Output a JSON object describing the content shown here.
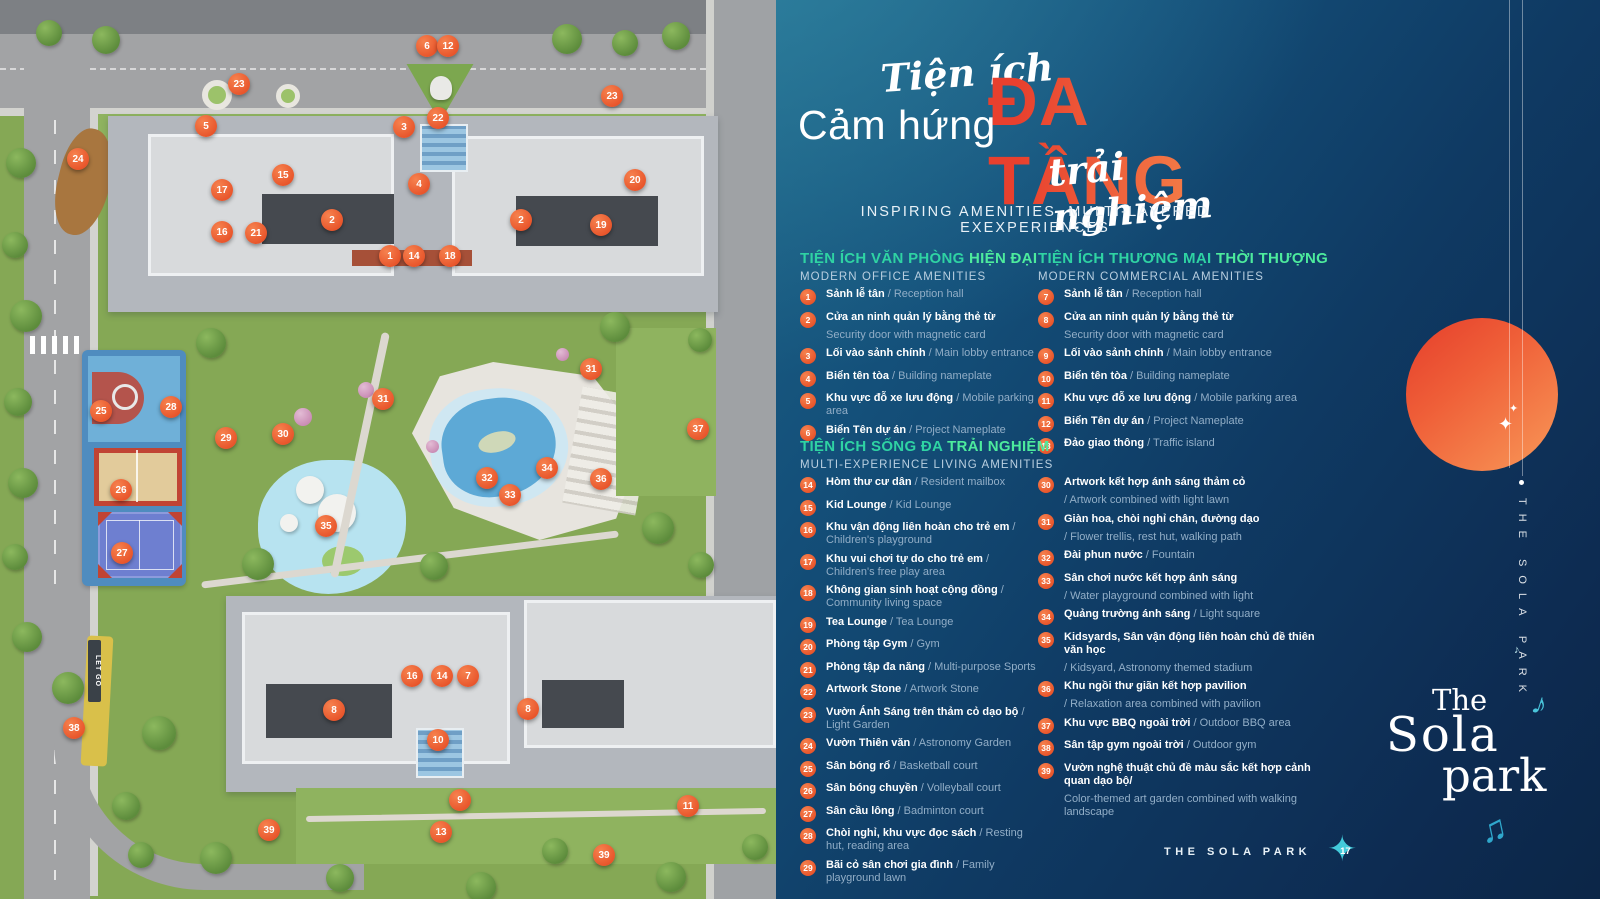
{
  "title": {
    "script_top": "Tiện ích",
    "main_left": "Cảm hứng",
    "main_accent": "ĐA TẦNG",
    "script_bottom": "trải nghiệm",
    "subtitle": "INSPIRING AMENITIES, MULTI-LAYERED EXEXPERIENCES"
  },
  "colors": {
    "accent_orange": "#F26A39",
    "title_gradient_start": "#E8402E",
    "title_gradient_end": "#F78F4F",
    "header_teal": "#2FD3A3",
    "header_teal_accent": "#4DEB9D",
    "panel_navy": "#0D2B51",
    "panel_teal": "#1C6386",
    "marker_orange": "#E8542A",
    "note_teal": "#49C4DA",
    "sun_red": "#E6422D",
    "sun_orange": "#F68A50"
  },
  "legend": {
    "sections": [
      {
        "title_vi": "TIỆN ÍCH VĂN PHÒNG ",
        "title_accent": "HIỆN ĐẠI",
        "title_en": "MODERN OFFICE AMENITIES",
        "items": [
          {
            "n": 1,
            "vi": "Sảnh lễ tân",
            "en": "/ Reception hall",
            "stack": false
          },
          {
            "n": 2,
            "vi": "Cửa an ninh quản lý bằng thẻ từ",
            "en": "Security door with magnetic card",
            "stack": true
          },
          {
            "n": 3,
            "vi": "Lối vào sảnh chính",
            "en": "/ Main lobby entrance",
            "stack": false
          },
          {
            "n": 4,
            "vi": "Biển tên tòa",
            "en": "/ Building nameplate",
            "stack": false
          },
          {
            "n": 5,
            "vi": "Khu vực đỗ xe lưu động",
            "en": "/ Mobile parking area",
            "stack": false
          },
          {
            "n": 6,
            "vi": "Biển Tên dự án",
            "en": "/ Project Nameplate",
            "stack": false
          }
        ]
      },
      {
        "title_vi": "TIỆN ÍCH THƯƠNG MẠI ",
        "title_accent": "THỜI THƯỢNG",
        "title_en": "MODERN COMMERCIAL AMENITIES",
        "items": [
          {
            "n": 7,
            "vi": "Sảnh lễ tân",
            "en": "/ Reception hall",
            "stack": false
          },
          {
            "n": 8,
            "vi": "Cửa an ninh quản lý bằng thẻ từ",
            "en": "Security door with magnetic card",
            "stack": true
          },
          {
            "n": 9,
            "vi": "Lối vào sảnh chính",
            "en": "/ Main lobby entrance",
            "stack": false
          },
          {
            "n": 10,
            "vi": "Biển tên tòa",
            "en": "/ Building nameplate",
            "stack": false
          },
          {
            "n": 11,
            "vi": "Khu vực đỗ xe lưu động",
            "en": "/ Mobile parking area",
            "stack": false
          },
          {
            "n": 12,
            "vi": "Biển Tên dự án",
            "en": "/ Project Nameplate",
            "stack": false
          },
          {
            "n": 13,
            "vi": "Đảo giao thông",
            "en": "/ Traffic island",
            "stack": false
          }
        ]
      },
      {
        "title_vi": "TIỆN ÍCH SỐNG ĐA ",
        "title_accent": "TRẢI NGHIỆM",
        "title_en": "MULTI-EXPERIENCE LIVING AMENITIES",
        "items_left": [
          {
            "n": 14,
            "vi": "Hòm thư cư dân",
            "en": "/ Resident mailbox",
            "stack": false
          },
          {
            "n": 15,
            "vi": "Kid Lounge",
            "en": "/ Kid Lounge",
            "stack": false
          },
          {
            "n": 16,
            "vi": "Khu vận động liên hoàn cho trẻ em",
            "en": "/ Children's playground",
            "stack": false
          },
          {
            "n": 17,
            "vi": "Khu vui chơi tự do cho trẻ em",
            "en": "/ Children's free play area",
            "stack": false
          },
          {
            "n": 18,
            "vi": "Không gian sinh hoạt cộng đồng",
            "en": "/ Community living space",
            "stack": false
          },
          {
            "n": 19,
            "vi": "Tea Lounge",
            "en": "/ Tea Lounge",
            "stack": false
          },
          {
            "n": 20,
            "vi": "Phòng tập Gym",
            "en": "/ Gym",
            "stack": false
          },
          {
            "n": 21,
            "vi": "Phòng tập đa năng",
            "en": "/ Multi-purpose Sports",
            "stack": false
          },
          {
            "n": 22,
            "vi": "Artwork Stone",
            "en": "/ Artwork Stone",
            "stack": false
          },
          {
            "n": 23,
            "vi": "Vườn Ánh Sáng trên thảm cỏ dạo bộ",
            "en": "/ Light Garden",
            "stack": false
          },
          {
            "n": 24,
            "vi": "Vườn Thiên văn",
            "en": "/ Astronomy Garden",
            "stack": false
          },
          {
            "n": 25,
            "vi": "Sân bóng rổ",
            "en": "/ Basketball court",
            "stack": false
          },
          {
            "n": 26,
            "vi": "Sân bóng chuyền",
            "en": "/ Volleyball court",
            "stack": false
          },
          {
            "n": 27,
            "vi": "Sân cầu lông",
            "en": "/ Badminton court",
            "stack": false
          },
          {
            "n": 28,
            "vi": "Chòi nghỉ, khu vực đọc sách",
            "en": "/ Resting hut, reading area",
            "stack": false
          },
          {
            "n": 29,
            "vi": "Bãi cỏ sân chơi gia đình",
            "en": "/ Family playground lawn",
            "stack": false
          }
        ],
        "items_right": [
          {
            "n": 30,
            "vi": "Artwork kết hợp ánh sáng thảm cỏ",
            "en": "/ Artwork combined with light lawn",
            "stack": true
          },
          {
            "n": 31,
            "vi": "Giàn hoa, chòi nghỉ chân, đường dạo",
            "en": "/ Flower trellis, rest hut, walking path",
            "stack": true
          },
          {
            "n": 32,
            "vi": "Đài phun nước",
            "en": "/ Fountain",
            "stack": false
          },
          {
            "n": 33,
            "vi": "Sân chơi nước kết hợp ánh sáng",
            "en": "/ Water playground combined with light",
            "stack": true
          },
          {
            "n": 34,
            "vi": "Quảng trường ánh sáng",
            "en": "/ Light square",
            "stack": false
          },
          {
            "n": 35,
            "vi": "Kidsyards, Sân vận động liên hoàn chủ đề thiên văn học",
            "en": "/ Kidsyard, Astronomy themed stadium",
            "stack": true
          },
          {
            "n": 36,
            "vi": "Khu ngồi thư giãn kết hợp pavilion",
            "en": "/ Relaxation area combined with pavilion",
            "stack": true
          },
          {
            "n": 37,
            "vi": "Khu vực BBQ ngoài trời",
            "en": "/ Outdoor BBQ area",
            "stack": false
          },
          {
            "n": 38,
            "vi": "Sân tập gym ngoài trời",
            "en": "/ Outdoor gym",
            "stack": false
          },
          {
            "n": 39,
            "vi": "Vườn nghệ thuật chủ đề màu sắc kết hợp cảnh quan dạo bộ/",
            "en": "Color-themed art garden combined with walking landscape",
            "stack": true
          }
        ]
      }
    ]
  },
  "footer": {
    "brand": "THE SOLA PARK",
    "page_number": "17",
    "star_icon": "four-point-star"
  },
  "side": {
    "vertical_text": "THE SOLA PARK",
    "logo_line1": "The",
    "logo_line2": "Sola",
    "logo_line3": "park",
    "music_note_1": "♪",
    "music_note_2": "♫",
    "tiny_note": "♪",
    "sparkle": "✦"
  },
  "map": {
    "labels": {
      "gym_sign": "LET GO"
    },
    "markers": [
      {
        "n": 6,
        "x": 427,
        "y": 46
      },
      {
        "n": 12,
        "x": 448,
        "y": 46
      },
      {
        "n": 23,
        "x": 239,
        "y": 84
      },
      {
        "n": 23,
        "x": 612,
        "y": 96
      },
      {
        "n": 22,
        "x": 438,
        "y": 118
      },
      {
        "n": 3,
        "x": 404,
        "y": 127
      },
      {
        "n": 5,
        "x": 206,
        "y": 126
      },
      {
        "n": 24,
        "x": 78,
        "y": 159
      },
      {
        "n": 15,
        "x": 283,
        "y": 175
      },
      {
        "n": 17,
        "x": 222,
        "y": 190
      },
      {
        "n": 4,
        "x": 419,
        "y": 184
      },
      {
        "n": 20,
        "x": 635,
        "y": 180
      },
      {
        "n": 2,
        "x": 332,
        "y": 220
      },
      {
        "n": 2,
        "x": 521,
        "y": 220
      },
      {
        "n": 19,
        "x": 601,
        "y": 225
      },
      {
        "n": 16,
        "x": 222,
        "y": 232
      },
      {
        "n": 21,
        "x": 256,
        "y": 233
      },
      {
        "n": 1,
        "x": 390,
        "y": 256
      },
      {
        "n": 14,
        "x": 414,
        "y": 256
      },
      {
        "n": 18,
        "x": 450,
        "y": 256
      },
      {
        "n": 31,
        "x": 383,
        "y": 399
      },
      {
        "n": 31,
        "x": 591,
        "y": 369
      },
      {
        "n": 25,
        "x": 101,
        "y": 411
      },
      {
        "n": 28,
        "x": 171,
        "y": 407
      },
      {
        "n": 29,
        "x": 226,
        "y": 438
      },
      {
        "n": 30,
        "x": 283,
        "y": 434
      },
      {
        "n": 37,
        "x": 698,
        "y": 429
      },
      {
        "n": 26,
        "x": 121,
        "y": 490
      },
      {
        "n": 27,
        "x": 122,
        "y": 553
      },
      {
        "n": 32,
        "x": 487,
        "y": 478
      },
      {
        "n": 33,
        "x": 510,
        "y": 495
      },
      {
        "n": 34,
        "x": 547,
        "y": 468
      },
      {
        "n": 36,
        "x": 601,
        "y": 479
      },
      {
        "n": 35,
        "x": 326,
        "y": 526
      },
      {
        "n": 16,
        "x": 412,
        "y": 676
      },
      {
        "n": 14,
        "x": 442,
        "y": 676
      },
      {
        "n": 7,
        "x": 468,
        "y": 676
      },
      {
        "n": 8,
        "x": 334,
        "y": 710
      },
      {
        "n": 8,
        "x": 528,
        "y": 709
      },
      {
        "n": 10,
        "x": 438,
        "y": 740
      },
      {
        "n": 9,
        "x": 460,
        "y": 800
      },
      {
        "n": 13,
        "x": 441,
        "y": 832
      },
      {
        "n": 11,
        "x": 688,
        "y": 806
      },
      {
        "n": 38,
        "x": 74,
        "y": 728
      },
      {
        "n": 39,
        "x": 269,
        "y": 830
      },
      {
        "n": 39,
        "x": 604,
        "y": 855
      }
    ],
    "trees": [
      {
        "x": 6,
        "y": 148,
        "s": 30
      },
      {
        "x": 2,
        "y": 232,
        "s": 26
      },
      {
        "x": 10,
        "y": 300,
        "s": 32
      },
      {
        "x": 4,
        "y": 388,
        "s": 28
      },
      {
        "x": 8,
        "y": 468,
        "s": 30
      },
      {
        "x": 2,
        "y": 544,
        "s": 26
      },
      {
        "x": 12,
        "y": 622,
        "s": 30
      },
      {
        "x": 36,
        "y": 20,
        "s": 26
      },
      {
        "x": 92,
        "y": 26,
        "s": 28
      },
      {
        "x": 552,
        "y": 24,
        "s": 30
      },
      {
        "x": 612,
        "y": 30,
        "s": 26
      },
      {
        "x": 662,
        "y": 22,
        "s": 28
      },
      {
        "x": 196,
        "y": 328,
        "s": 30
      },
      {
        "x": 242,
        "y": 548,
        "s": 32
      },
      {
        "x": 420,
        "y": 552,
        "s": 28
      },
      {
        "x": 600,
        "y": 312,
        "s": 30
      },
      {
        "x": 642,
        "y": 512,
        "s": 32
      },
      {
        "x": 688,
        "y": 552,
        "s": 26
      },
      {
        "x": 688,
        "y": 328,
        "s": 24
      },
      {
        "x": 52,
        "y": 672,
        "s": 32
      },
      {
        "x": 142,
        "y": 716,
        "s": 34
      },
      {
        "x": 112,
        "y": 792,
        "s": 28
      },
      {
        "x": 200,
        "y": 842,
        "s": 32
      },
      {
        "x": 128,
        "y": 842,
        "s": 26
      },
      {
        "x": 326,
        "y": 864,
        "s": 28
      },
      {
        "x": 466,
        "y": 872,
        "s": 30
      },
      {
        "x": 542,
        "y": 838,
        "s": 26
      },
      {
        "x": 656,
        "y": 862,
        "s": 30
      },
      {
        "x": 742,
        "y": 834,
        "s": 26
      }
    ],
    "pink_trees": [
      {
        "x": 294,
        "y": 408,
        "s": 18
      },
      {
        "x": 358,
        "y": 382,
        "s": 16
      },
      {
        "x": 426,
        "y": 440,
        "s": 13
      },
      {
        "x": 556,
        "y": 348,
        "s": 13
      }
    ]
  }
}
